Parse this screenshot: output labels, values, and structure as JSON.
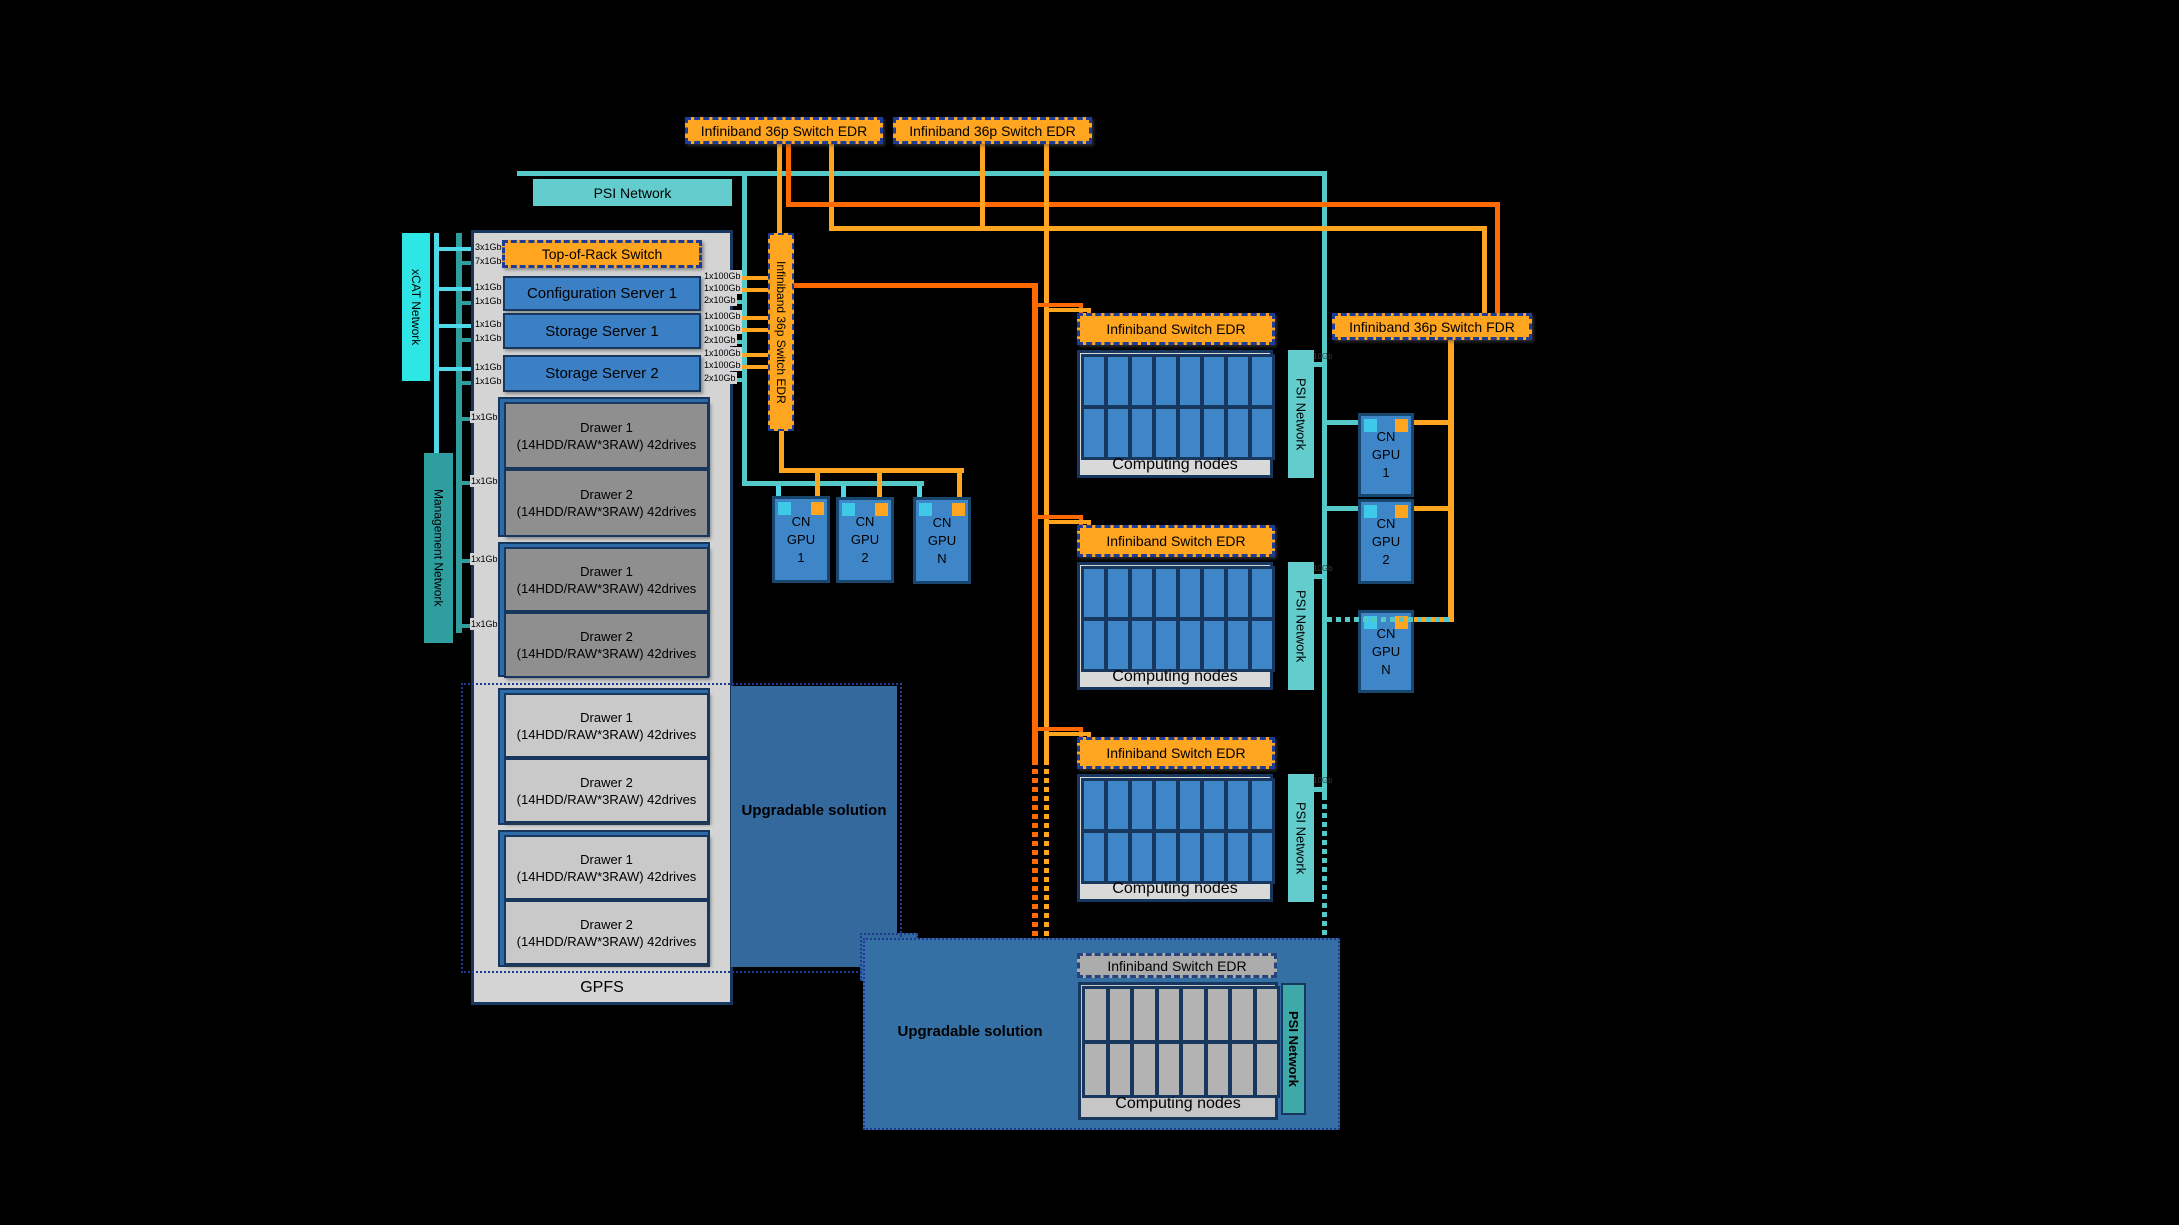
{
  "diagram": {
    "top_switch_1": "Infiniband 36p Switch EDR",
    "top_switch_2": "Infiniband 36p Switch EDR",
    "psi_bar": "PSI Network",
    "xcat_label": "xCAT Network",
    "management_label": "Management Network",
    "vertical_switch": "Infiniband 36p Switch EDR",
    "fdr_switch": "Infiniband 36p Switch FDR",
    "gpfs": "GPFS",
    "upgradable_1": "Upgradable solution",
    "upgradable_2": "Upgradable solution",
    "tor": {
      "label": "Top-of-Rack Switch",
      "links_left": [
        "3x1Gb",
        "7x1Gb"
      ]
    },
    "servers": [
      {
        "name": "Configuration Server 1",
        "links_left": [
          "1x1Gb",
          "1x1Gb"
        ],
        "links_right": [
          "1x100Gb",
          "1x100Gb",
          "2x10Gb"
        ]
      },
      {
        "name": "Storage Server 1",
        "links_left": [
          "1x1Gb",
          "1x1Gb"
        ],
        "links_right": [
          "1x100Gb",
          "1x100Gb",
          "2x10Gb"
        ]
      },
      {
        "name": "Storage Server 2",
        "links_left": [
          "1x1Gb",
          "1x1Gb"
        ],
        "links_right": [
          "1x100Gb",
          "1x100Gb",
          "2x10Gb"
        ]
      }
    ],
    "drawer_links": [
      "1x1Gb",
      "1x1Gb",
      "1x1Gb",
      "1x1Gb"
    ],
    "drawer_groups": [
      {
        "items": [
          {
            "t": "Drawer 1",
            "s": "(14HDD/RAW*3RAW) 42drives"
          },
          {
            "t": "Drawer 2",
            "s": "(14HDD/RAW*3RAW) 42drives"
          }
        ]
      },
      {
        "items": [
          {
            "t": "Drawer 1",
            "s": "(14HDD/RAW*3RAW) 42drives"
          },
          {
            "t": "Drawer 2",
            "s": "(14HDD/RAW*3RAW) 42drives"
          }
        ]
      },
      {
        "items": [
          {
            "t": "Drawer 1",
            "s": "(14HDD/RAW*3RAW) 42drives"
          },
          {
            "t": "Drawer 2",
            "s": "(14HDD/RAW*3RAW) 42drives"
          }
        ]
      },
      {
        "items": [
          {
            "t": "Drawer 1",
            "s": "(14HDD/RAW*3RAW) 42drives"
          },
          {
            "t": "Drawer 2",
            "s": "(14HDD/RAW*3RAW) 42drives"
          }
        ]
      }
    ],
    "compute_blocks": [
      {
        "switch": "Infiniband Switch EDR",
        "caption": "Computing nodes",
        "psi": "PSI Network",
        "uplink": "10Gb"
      },
      {
        "switch": "Infiniband Switch EDR",
        "caption": "Computing nodes",
        "psi": "PSI Network",
        "uplink": "10Gb"
      },
      {
        "switch": "Infiniband Switch EDR",
        "caption": "Computing nodes",
        "psi": "PSI Network",
        "uplink": "10Gb"
      },
      {
        "switch": "Infiniband Switch EDR",
        "caption": "Computing nodes",
        "psi": "PSI Network"
      }
    ],
    "gpus_left": [
      {
        "l1": "CN",
        "l2": "GPU",
        "l3": "1"
      },
      {
        "l1": "CN",
        "l2": "GPU",
        "l3": "2"
      },
      {
        "l1": "CN",
        "l2": "GPU",
        "l3": "N"
      }
    ],
    "gpus_right": [
      {
        "l1": "CN",
        "l2": "GPU",
        "l3": "1"
      },
      {
        "l1": "CN",
        "l2": "GPU",
        "l3": "2"
      },
      {
        "l1": "CN",
        "l2": "GPU",
        "l3": "N"
      }
    ],
    "colors": {
      "orange": "#FFA51F",
      "dark_orange": "#FF6A00",
      "teal": "#55C8C8",
      "cyan": "#4FD8E8",
      "xcat_cyan": "#2EE6E6",
      "mgmt_teal": "#2E9E9E",
      "node_blue": "#3F86C9",
      "navy_border": "#17375E",
      "steel_blue": "#34699E",
      "container_gray": "#D4D4D4"
    }
  }
}
